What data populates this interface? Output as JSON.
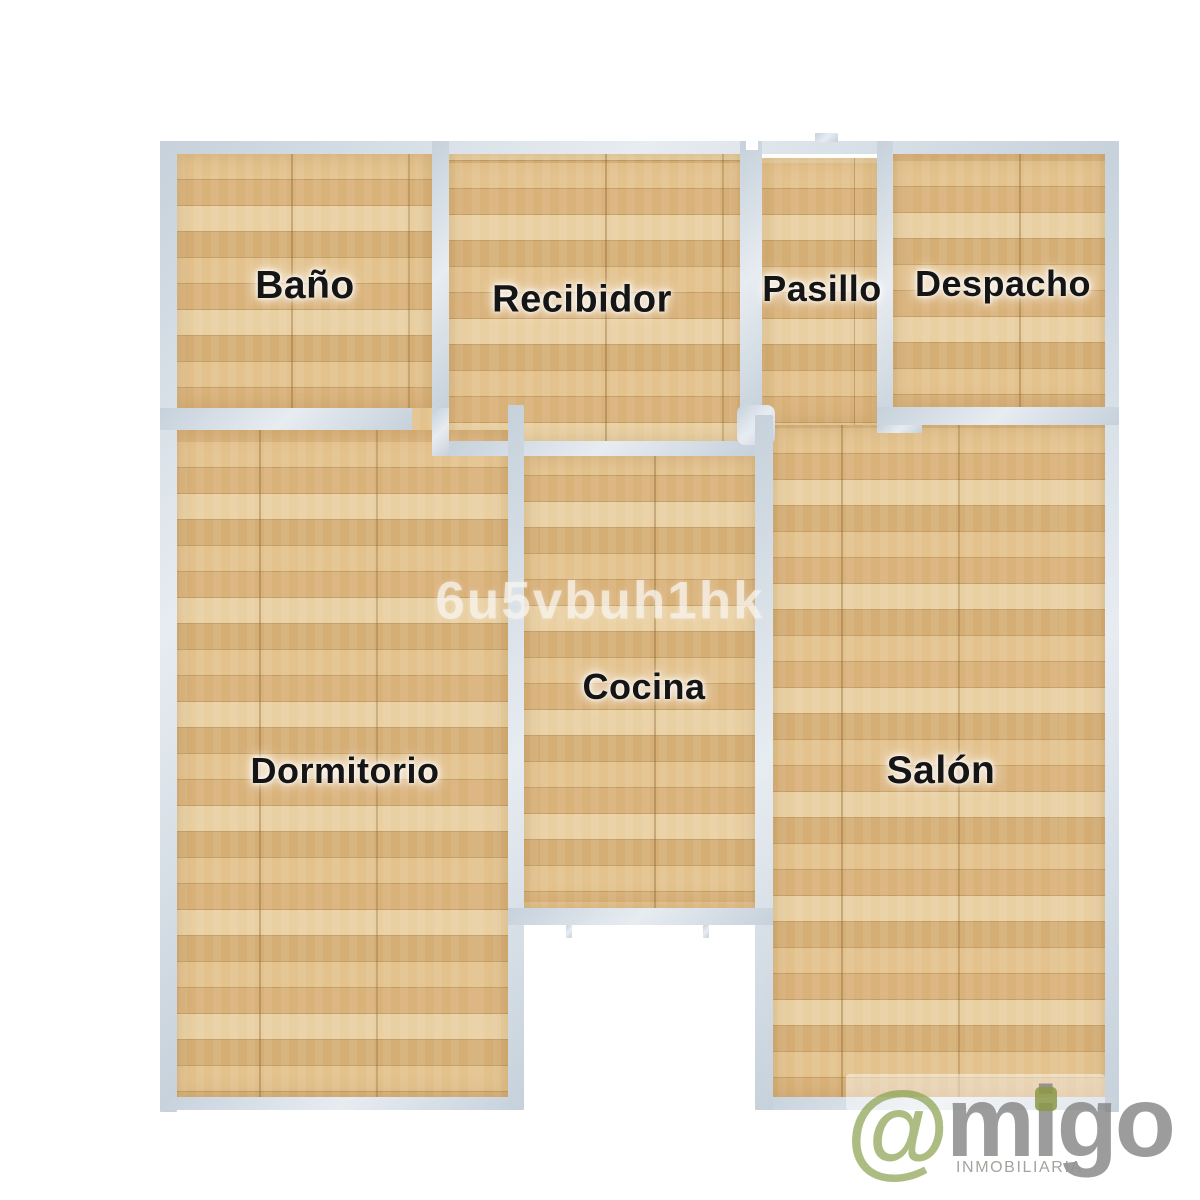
{
  "plan": {
    "watermark": "6u5vbuh1hk",
    "rooms": [
      {
        "name": "bano",
        "label": "Baño"
      },
      {
        "name": "recibidor",
        "label": "Recibidor"
      },
      {
        "name": "pasillo",
        "label": "Pasillo"
      },
      {
        "name": "despacho",
        "label": "Despacho"
      },
      {
        "name": "dormitorio",
        "label": "Dormitorio"
      },
      {
        "name": "cocina",
        "label": "Cocina"
      },
      {
        "name": "salon",
        "label": "Salón"
      }
    ]
  },
  "logo": {
    "symbol": "@",
    "brand": "migo",
    "tagline": "INMOBILIARIA"
  },
  "colors": {
    "wall": "#cfd9e2",
    "floor": "#dcb67e",
    "logo_green": "#8ca252",
    "logo_gray": "#a9a9a9",
    "label_text": "#151515"
  }
}
